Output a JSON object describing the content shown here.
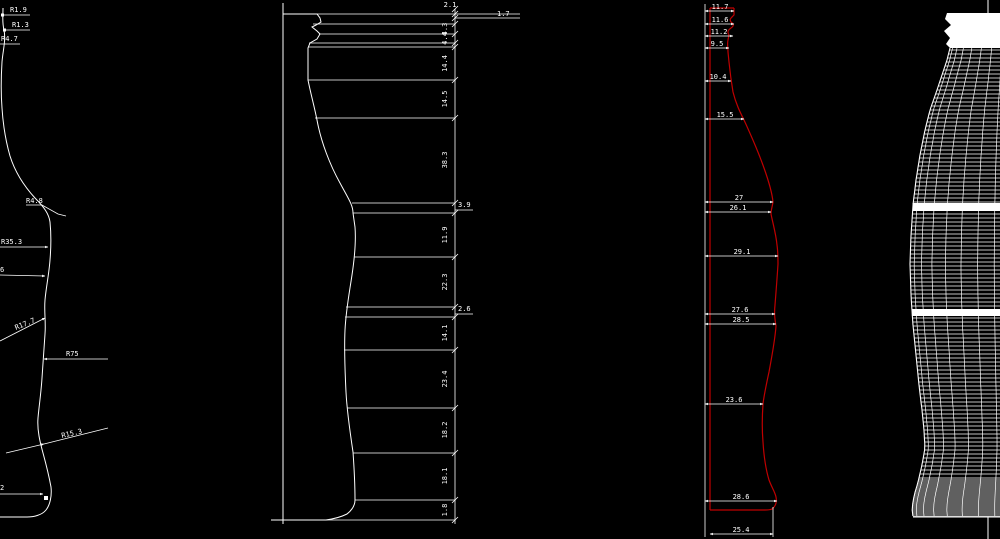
{
  "drawing": {
    "subject": "contour-bottle-technical-drawing",
    "colors": {
      "background": "#000000",
      "lines": "#ffffff",
      "red_profile": "#c00000"
    },
    "view1_radius_callouts": {
      "callouts": [
        "R1.9",
        "R1.3",
        "R4.7",
        "R4.8",
        "R35.3",
        "6",
        "R17.7",
        "R75",
        "R15.3",
        "2"
      ]
    },
    "view2_vertical_dims": {
      "dims": [
        "2.1",
        "1.7",
        "4.3",
        "4.4",
        "14.4",
        "14.5",
        "38.3",
        "3.9",
        "11.9",
        "22.3",
        "2.6",
        "14.1",
        "23.4",
        "18.2",
        "18.1",
        "1.8"
      ]
    },
    "view3_width_dims": {
      "dims": [
        "11.7",
        "11.6",
        "11.2",
        "9.5",
        "10.4",
        "15.5",
        "27",
        "26.1",
        "29.1",
        "27.6",
        "28.5",
        "23.6",
        "28.6",
        "25.4"
      ]
    },
    "view4_wireframe": {
      "description": "3d-wireframe-mesh-bottle"
    }
  }
}
